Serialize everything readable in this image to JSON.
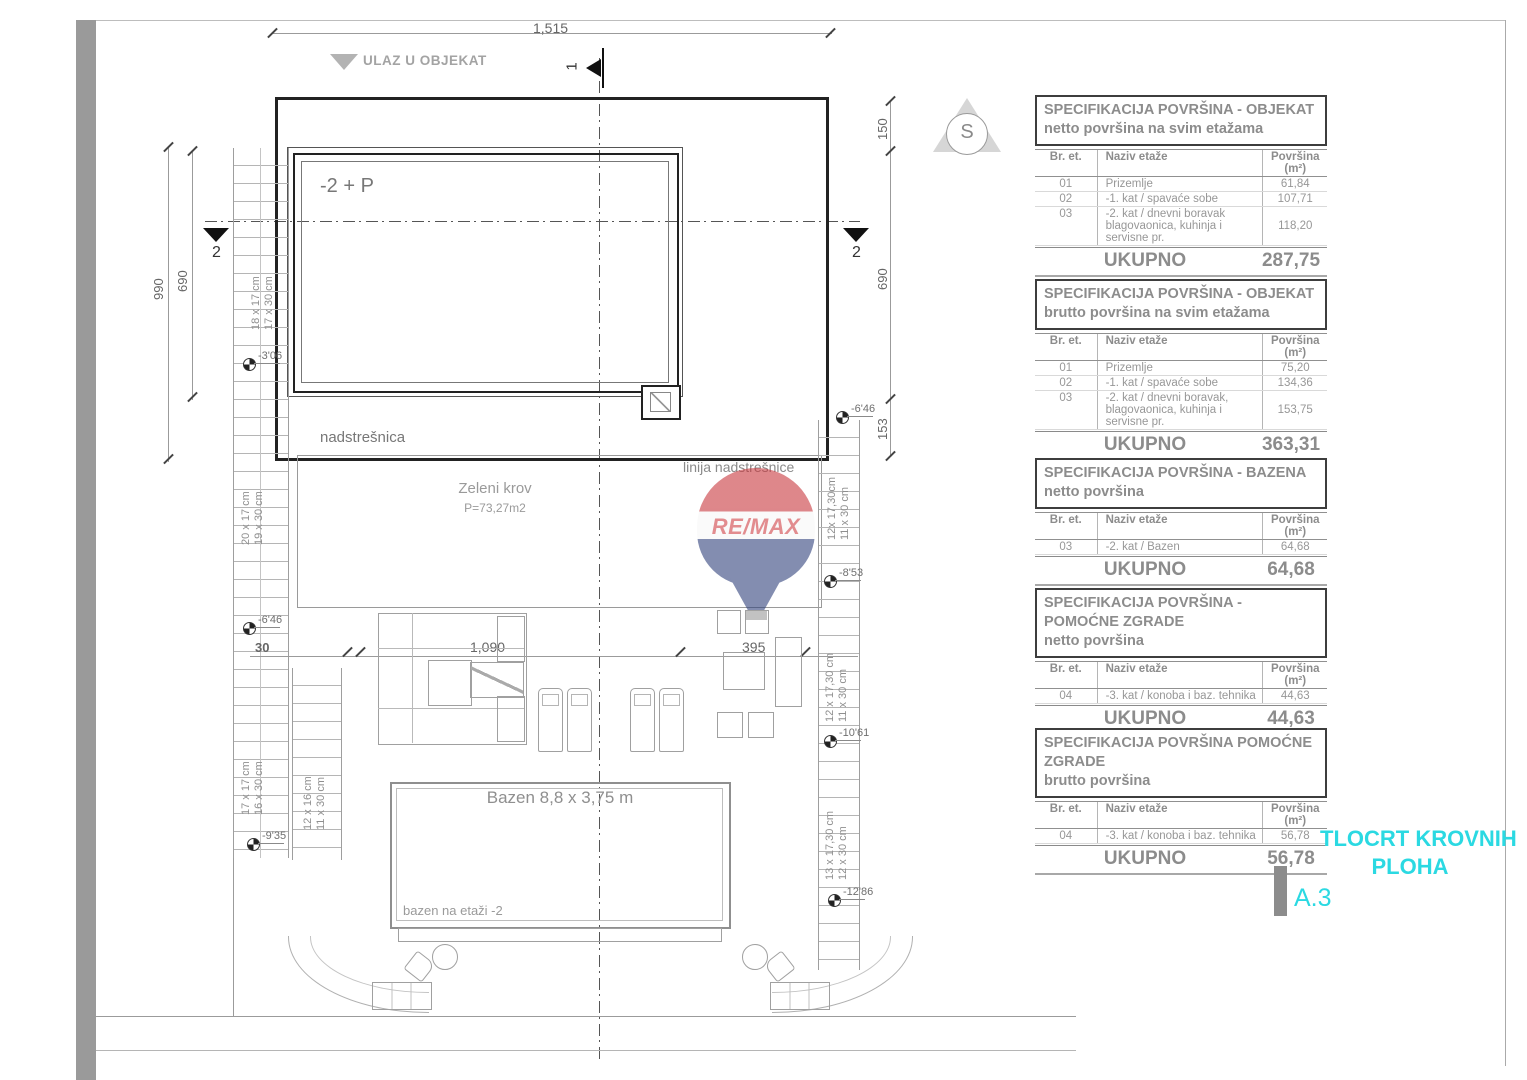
{
  "colors": {
    "accent_cyan": "#2bd9e2",
    "logo_red": "#c8373d",
    "logo_blue": "#31427c",
    "line_gray": "#999999"
  },
  "plan": {
    "entrance_label": "ULAZ U OBJEKAT",
    "building_label": "-2 + P",
    "canopy_label": "nadstrešnica",
    "canopy_line_label": "linija nadstrešnice",
    "green_roof_label": "Zeleni krov",
    "green_roof_area": "P=73,27m2",
    "pool_label": "Bazen 8,8 x 3,75 m",
    "pool_note": "bazen na etaži -2",
    "compass_letter": "S",
    "section_1": "1",
    "section_2": "2",
    "dims": {
      "total_width": "1,515",
      "left_total": "990",
      "left_inner": "690",
      "right_top": "150",
      "right_mid": "690",
      "right_low": "153",
      "terrace_wall": "30",
      "terrace_main": "1,090",
      "terrace_right": "395"
    },
    "stairs": [
      {
        "a": "18 x 17 cm",
        "b": "17 x 30 cm"
      },
      {
        "a": "20 x 17 cm",
        "b": "19 x 30 cm"
      },
      {
        "a": "17 x 17 cm",
        "b": "16 x 30 cm"
      },
      {
        "a": "12 x 16 cm",
        "b": "11 x 30 cm"
      },
      {
        "a": "12x 17,30cm",
        "b": "11 x 30 cm"
      },
      {
        "a": "12 x 17,30 cm",
        "b": "11 x 30 cm"
      },
      {
        "a": "13 x 17,30 cm",
        "b": "12 x 30 cm"
      }
    ],
    "elevations": {
      "l1": "-3'06",
      "l2": "-6'46",
      "l3": "-9'35",
      "r1": "-6'46",
      "r2": "-8'53",
      "r3": "-10'61",
      "r4": "-12'86"
    }
  },
  "logo": {
    "text": "RE/MAX"
  },
  "tables": [
    {
      "title": "SPECIFIKACIJA POVRŠINA - OBJEKAT",
      "subtitle": "netto površina na svim etažama",
      "col_num": "Br. et.",
      "col_name": "Naziv etaže",
      "col_area": "Površina (m²)",
      "rows": [
        {
          "num": "01",
          "name": "Prizemlje",
          "area": "61,84"
        },
        {
          "num": "02",
          "name": "-1. kat / spavaće sobe",
          "area": "107,71"
        },
        {
          "num": "03",
          "name": "-2. kat / dnevni boravak",
          "name2": "blagovaonica, kuhinja i servisne pr.",
          "area": "118,20"
        }
      ],
      "total_label": "UKUPNO",
      "total": "287,75"
    },
    {
      "title": "SPECIFIKACIJA POVRŠINA - OBJEKAT",
      "subtitle": "brutto površina na svim etažama",
      "col_num": "Br. et.",
      "col_name": "Naziv etaže",
      "col_area": "Površina (m²)",
      "rows": [
        {
          "num": "01",
          "name": "Prizemlje",
          "area": "75,20"
        },
        {
          "num": "02",
          "name": "-1. kat / spavaće sobe",
          "area": "134,36"
        },
        {
          "num": "03",
          "name": "-2. kat / dnevni boravak,",
          "name2": "blagovaonica, kuhinja i servisne pr.",
          "area": "153,75"
        }
      ],
      "total_label": "UKUPNO",
      "total": "363,31"
    },
    {
      "title": "SPECIFIKACIJA POVRŠINA - BAZENA",
      "subtitle": "netto površina",
      "col_num": "Br. et.",
      "col_name": "Naziv etaže",
      "col_area": "Površina (m²)",
      "rows": [
        {
          "num": "03",
          "name": "-2. kat / Bazen",
          "area": "64,68"
        }
      ],
      "total_label": "UKUPNO",
      "total": "64,68"
    },
    {
      "title": "SPECIFIKACIJA POVRŠINA - POMOĆNE ZGRADE",
      "subtitle": "netto površina",
      "col_num": "Br. et.",
      "col_name": "Naziv etaže",
      "col_area": "Površina (m²)",
      "rows": [
        {
          "num": "04",
          "name": "-3. kat / konoba i baz. tehnika",
          "area": "44,63"
        }
      ],
      "total_label": "UKUPNO",
      "total": "44,63"
    },
    {
      "title": "SPECIFIKACIJA POVRŠINA POMOĆNE ZGRADE",
      "subtitle": "brutto površina",
      "col_num": "Br. et.",
      "col_name": "Naziv etaže",
      "col_area": "Površina (m²)",
      "rows": [
        {
          "num": "04",
          "name": "-3. kat / konoba i baz. tehnika",
          "area": "56,78"
        }
      ],
      "total_label": "UKUPNO",
      "total": "56,78"
    }
  ],
  "titleblock": {
    "line1": "TLOCRT KROVNIH",
    "line2": "PLOHA",
    "sheet": "A.3"
  }
}
